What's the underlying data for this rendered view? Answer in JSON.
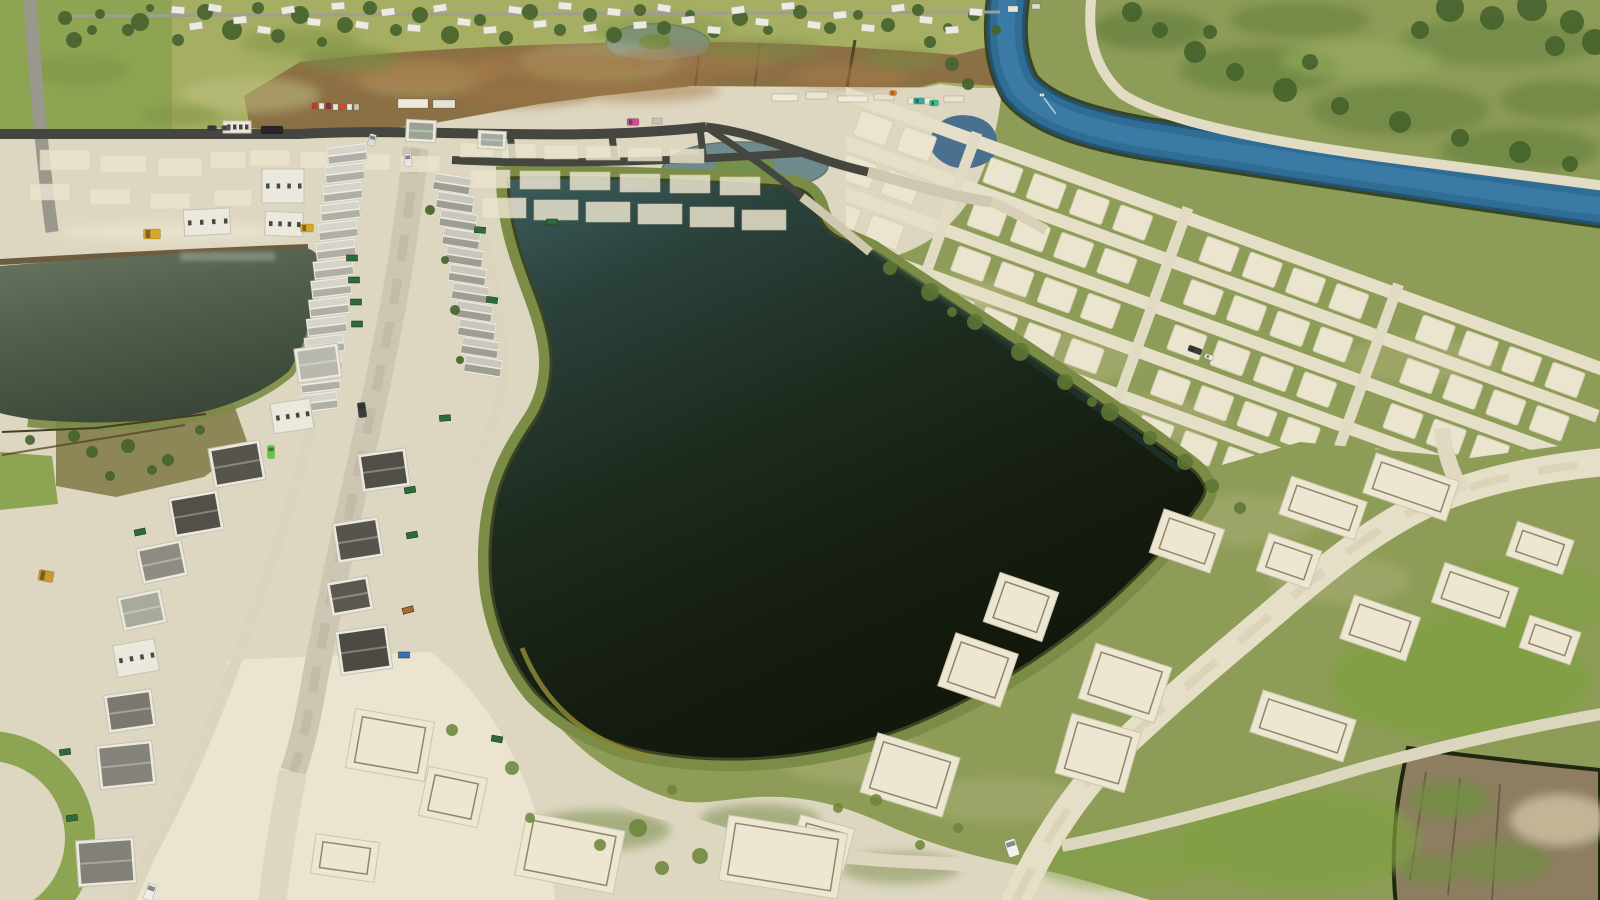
{
  "scene": {
    "kind": "aerial-drone-photo",
    "subject": "residential-construction-site-with-retention-pond-and-canal"
  },
  "palette": {
    "sand": "#ddd7c1",
    "sandBright": "#ece6d2",
    "grass": "#8d9c57",
    "grassTop": "#a5ae62",
    "grassLeft": "#8da452",
    "grassVivid": "#7fa040",
    "scrub": "#8c7045",
    "asphalt": "#45463f",
    "street": "#ccc6b3",
    "dirt": "#dcd5be",
    "canal": "#2f6d94",
    "canalLight": "#3e80ab",
    "canalBank": "#2e3c20",
    "levee": "#e2dcc4",
    "fieldNE": "#83a055",
    "treeGreen": "#46632e",
    "lakeFringe": "#7a8c46",
    "plowField": "#8d7e61",
    "plowEdge": "#20260f",
    "padFill": "#ebe4cf",
    "padEdge": "#d6cfb6",
    "houseWhite": "#ebe8de"
  },
  "trees": [
    [
      65,
      18,
      7
    ],
    [
      92,
      30,
      5
    ],
    [
      140,
      22,
      9
    ],
    [
      178,
      40,
      6
    ],
    [
      205,
      12,
      8
    ],
    [
      232,
      30,
      10
    ],
    [
      258,
      8,
      6
    ],
    [
      278,
      36,
      7
    ],
    [
      300,
      15,
      9
    ],
    [
      322,
      42,
      5
    ],
    [
      345,
      25,
      8
    ],
    [
      370,
      8,
      7
    ],
    [
      396,
      30,
      6
    ],
    [
      420,
      15,
      8
    ],
    [
      450,
      35,
      9
    ],
    [
      480,
      20,
      6
    ],
    [
      506,
      38,
      7
    ],
    [
      530,
      12,
      8
    ],
    [
      560,
      30,
      6
    ],
    [
      590,
      15,
      7
    ],
    [
      614,
      35,
      8
    ],
    [
      640,
      10,
      6
    ],
    [
      664,
      28,
      7
    ],
    [
      690,
      15,
      5
    ],
    [
      714,
      32,
      6
    ],
    [
      740,
      18,
      8
    ],
    [
      768,
      30,
      5
    ],
    [
      800,
      12,
      7
    ],
    [
      830,
      28,
      6
    ],
    [
      858,
      15,
      5
    ],
    [
      888,
      25,
      7
    ],
    [
      918,
      10,
      6
    ],
    [
      948,
      28,
      5
    ],
    [
      974,
      15,
      6
    ],
    [
      996,
      30,
      5
    ],
    [
      100,
      14,
      5
    ],
    [
      128,
      30,
      6
    ],
    [
      74,
      40,
      8
    ],
    [
      150,
      8,
      4
    ],
    [
      1132,
      12,
      10
    ],
    [
      1160,
      30,
      8
    ],
    [
      1195,
      52,
      11
    ],
    [
      1235,
      72,
      9
    ],
    [
      1285,
      90,
      12
    ],
    [
      1340,
      106,
      9
    ],
    [
      1400,
      122,
      11
    ],
    [
      1460,
      138,
      9
    ],
    [
      1520,
      152,
      11
    ],
    [
      1570,
      164,
      8
    ],
    [
      1210,
      32,
      7
    ],
    [
      1310,
      62,
      8
    ],
    [
      1450,
      8,
      14
    ],
    [
      1492,
      18,
      12
    ],
    [
      1532,
      6,
      15
    ],
    [
      1572,
      22,
      12
    ],
    [
      1595,
      42,
      13
    ],
    [
      1555,
      46,
      10
    ],
    [
      1420,
      30,
      9
    ],
    [
      930,
      42,
      6
    ],
    [
      952,
      64,
      7
    ],
    [
      968,
      84,
      6
    ],
    [
      30,
      440,
      5
    ],
    [
      74,
      436,
      6
    ],
    [
      128,
      446,
      7
    ],
    [
      168,
      460,
      6
    ],
    [
      110,
      476,
      5
    ],
    [
      152,
      470,
      5
    ],
    [
      92,
      452,
      6
    ],
    [
      200,
      430,
      5
    ],
    [
      430,
      210,
      5
    ],
    [
      445,
      260,
      4
    ],
    [
      455,
      310,
      5
    ],
    [
      460,
      360,
      4
    ]
  ],
  "nbhdHouses": [
    [
      178,
      10,
      5
    ],
    [
      196,
      26,
      -8
    ],
    [
      215,
      8,
      10
    ],
    [
      240,
      20,
      -5
    ],
    [
      264,
      30,
      8
    ],
    [
      288,
      10,
      -10
    ],
    [
      314,
      22,
      6
    ],
    [
      338,
      6,
      -4
    ],
    [
      362,
      25,
      9
    ],
    [
      388,
      12,
      -7
    ],
    [
      414,
      28,
      4
    ],
    [
      440,
      8,
      -9
    ],
    [
      464,
      22,
      7
    ],
    [
      490,
      30,
      -5
    ],
    [
      515,
      10,
      8
    ],
    [
      540,
      24,
      -6
    ],
    [
      565,
      6,
      5
    ],
    [
      590,
      28,
      -8
    ],
    [
      614,
      12,
      6
    ],
    [
      640,
      25,
      -4
    ],
    [
      664,
      8,
      9
    ],
    [
      688,
      20,
      -6
    ],
    [
      714,
      30,
      5
    ],
    [
      738,
      10,
      -8
    ],
    [
      762,
      22,
      6
    ],
    [
      788,
      6,
      -5
    ],
    [
      814,
      25,
      8
    ],
    [
      840,
      15,
      -6
    ],
    [
      868,
      28,
      5
    ],
    [
      898,
      8,
      -7
    ],
    [
      926,
      20,
      6
    ],
    [
      952,
      30,
      -5
    ],
    [
      976,
      12,
      4
    ]
  ],
  "lots": [
    [
      460,
      143,
      34,
      14
    ],
    [
      502,
      144,
      34,
      14
    ],
    [
      544,
      145,
      34,
      14
    ],
    [
      586,
      146,
      34,
      14
    ],
    [
      628,
      147,
      34,
      14
    ],
    [
      670,
      149,
      34,
      14
    ],
    [
      470,
      170,
      40,
      18
    ],
    [
      520,
      171,
      40,
      18
    ],
    [
      570,
      172,
      40,
      18
    ],
    [
      620,
      174,
      40,
      18
    ],
    [
      670,
      175,
      40,
      18
    ],
    [
      720,
      177,
      40,
      18
    ],
    [
      482,
      198,
      44,
      20
    ],
    [
      534,
      200,
      44,
      20
    ],
    [
      586,
      202,
      44,
      20
    ],
    [
      638,
      204,
      44,
      20
    ],
    [
      690,
      207,
      44,
      20
    ],
    [
      742,
      210,
      44,
      20
    ],
    [
      250,
      150,
      40,
      16
    ],
    [
      300,
      152,
      40,
      16
    ],
    [
      350,
      154,
      40,
      16
    ],
    [
      400,
      156,
      40,
      16
    ],
    [
      40,
      150,
      50,
      20
    ],
    [
      100,
      155,
      46,
      18
    ],
    [
      158,
      158,
      44,
      18
    ],
    [
      30,
      184,
      40,
      16
    ],
    [
      90,
      189,
      40,
      16
    ],
    [
      150,
      193,
      40,
      16
    ],
    [
      210,
      152,
      36,
      16
    ],
    [
      214,
      190,
      38,
      16
    ]
  ],
  "mottles": [
    [
      250,
      95,
      70,
      18,
      "#c2c285",
      0.5
    ],
    [
      420,
      80,
      60,
      15,
      "#bfbf80",
      0.45
    ],
    [
      600,
      62,
      80,
      20,
      "#c2c285",
      0.4
    ],
    [
      80,
      70,
      50,
      16,
      "#7e9346",
      0.5
    ],
    [
      300,
      42,
      60,
      14,
      "#7e9346",
      0.5
    ],
    [
      660,
      30,
      70,
      16,
      "#7e9346",
      0.4
    ],
    [
      180,
      115,
      40,
      10,
      "#7e9346",
      0.5
    ],
    [
      420,
      75,
      80,
      16,
      "#a5794a",
      0.7
    ],
    [
      560,
      66,
      90,
      14,
      "#a5794a",
      0.6
    ],
    [
      700,
      60,
      80,
      14,
      "#a5794a",
      0.6
    ],
    [
      850,
      76,
      60,
      12,
      "#a5794a",
      0.6
    ],
    [
      520,
      95,
      70,
      12,
      "#9b7245",
      0.6
    ],
    [
      640,
      90,
      80,
      12,
      "#a5794a",
      0.5
    ],
    [
      350,
      60,
      50,
      12,
      "#7c8a44",
      0.7
    ],
    [
      760,
      50,
      60,
      10,
      "#7c8a44",
      0.6
    ],
    [
      900,
      60,
      40,
      10,
      "#7c8a44",
      0.6
    ],
    [
      1150,
      30,
      60,
      20,
      "#5e7c3a",
      0.6
    ],
    [
      1260,
      70,
      80,
      24,
      "#5e7c3a",
      0.55
    ],
    [
      1400,
      110,
      90,
      26,
      "#5e7c3a",
      0.5
    ],
    [
      1520,
      150,
      80,
      22,
      "#5e7c3a",
      0.55
    ],
    [
      1300,
      20,
      70,
      18,
      "#5e7c3a",
      0.5
    ],
    [
      1500,
      42,
      100,
      24,
      "#5e7c3a",
      0.45
    ],
    [
      1360,
      60,
      80,
      20,
      "#9ab05e",
      0.5
    ],
    [
      1560,
      100,
      60,
      20,
      "#5e7c3a",
      0.5
    ],
    [
      940,
      300,
      90,
      26,
      "#b9b885",
      0.45
    ],
    [
      1040,
      360,
      100,
      28,
      "#b9b885",
      0.4
    ],
    [
      1140,
      420,
      90,
      24,
      "#b9b885",
      0.4
    ],
    [
      880,
      520,
      60,
      40,
      "#b9b885",
      0.35
    ],
    [
      920,
      620,
      70,
      30,
      "#b9b885",
      0.4
    ],
    [
      1240,
      520,
      80,
      26,
      "#b9b885",
      0.35
    ],
    [
      1340,
      580,
      70,
      24,
      "#b9b885",
      0.35
    ],
    [
      860,
      760,
      80,
      24,
      "#b9b885",
      0.4
    ],
    [
      1000,
      800,
      90,
      22,
      "#b9b885",
      0.35
    ],
    [
      1420,
      360,
      80,
      22,
      "#b9b885",
      0.35
    ],
    [
      600,
      830,
      70,
      20,
      "#6f8440",
      0.5
    ],
    [
      760,
      820,
      60,
      16,
      "#6f8440",
      0.5
    ],
    [
      900,
      868,
      60,
      16,
      "#6f8440",
      0.45
    ],
    [
      1460,
      680,
      130,
      60,
      "#7fa040",
      0.75
    ],
    [
      1300,
      840,
      120,
      50,
      "#7fa040",
      0.7
    ],
    [
      1520,
      600,
      90,
      40,
      "#7fa040",
      0.6
    ],
    [
      1120,
      860,
      90,
      30,
      "#7fa040",
      0.5
    ],
    [
      1450,
      800,
      40,
      18,
      "#6f8f3f",
      0.8
    ],
    [
      1500,
      862,
      50,
      20,
      "#6f8f3f",
      0.7
    ],
    [
      1560,
      820,
      50,
      26,
      "#cfc3a4",
      0.8
    ],
    [
      1430,
      870,
      30,
      14,
      "#6f8f3f",
      0.7
    ],
    [
      180,
      232,
      120,
      10,
      "#e9e3cf",
      0.8
    ],
    [
      960,
      300,
      40,
      12,
      "#c6c490",
      0.5
    ]
  ],
  "neGrid": {
    "x": 852,
    "y": 96,
    "angle": 20,
    "len": 820,
    "roadYs": [
      0,
      46,
      94,
      142,
      190,
      238
    ],
    "rowYs": [
      23,
      69,
      117,
      165,
      213
    ],
    "colX0": 14,
    "colPitch": 46,
    "cols": 17,
    "padW": 34,
    "padH": 26,
    "connXs": [
      130,
      354,
      578
    ]
  },
  "sePads": [
    [
      1187,
      541,
      64,
      46,
      19
    ],
    [
      1323,
      508,
      80,
      40,
      19
    ],
    [
      1411,
      487,
      88,
      42,
      19
    ],
    [
      1021,
      607,
      62,
      52,
      19
    ],
    [
      978,
      670,
      66,
      56,
      19
    ],
    [
      910,
      775,
      86,
      62,
      17
    ],
    [
      822,
      843,
      56,
      44,
      15
    ],
    [
      1380,
      628,
      70,
      46,
      19
    ],
    [
      1475,
      595,
      78,
      42,
      19
    ],
    [
      1303,
      726,
      98,
      44,
      18
    ],
    [
      1125,
      683,
      80,
      58,
      18
    ],
    [
      1098,
      753,
      72,
      62,
      16
    ],
    [
      1289,
      561,
      56,
      40,
      19
    ],
    [
      1540,
      548,
      60,
      36,
      19
    ],
    [
      570,
      853,
      100,
      64,
      11
    ],
    [
      783,
      857,
      120,
      66,
      9
    ],
    [
      453,
      797,
      60,
      50,
      12
    ],
    [
      390,
      745,
      80,
      60,
      10
    ],
    [
      1550,
      640,
      54,
      34,
      19
    ],
    [
      345,
      858,
      64,
      40,
      8
    ]
  ],
  "townhomeRows": [
    {
      "x1": 347,
      "y1": 154,
      "x2": 318,
      "y2": 402,
      "n": 14,
      "rot": -7,
      "w": 38,
      "d": 15,
      "roofA": "#d6d4ca",
      "roofB": "#b0afa5"
    },
    {
      "x1": 452,
      "y1": 184,
      "x2": 483,
      "y2": 366,
      "n": 11,
      "rot": 9,
      "w": 36,
      "d": 15,
      "roofA": "#c9c7bd",
      "roofB": "#9e9d93"
    }
  ],
  "houses": [
    [
      283,
      186,
      0,
      42,
      34,
      "b",
      ""
    ],
    [
      207,
      222,
      -3,
      46,
      26,
      "b",
      ""
    ],
    [
      284,
      224,
      2,
      38,
      24,
      "b",
      ""
    ],
    [
      237,
      127,
      0,
      28,
      12,
      "b",
      ""
    ],
    [
      318,
      363,
      -8,
      44,
      34,
      "r",
      "#b9b8ad"
    ],
    [
      292,
      416,
      -8,
      40,
      30,
      "b",
      ""
    ],
    [
      237,
      464,
      -10,
      52,
      40,
      "r",
      "#57544c"
    ],
    [
      196,
      514,
      -10,
      50,
      40,
      "r",
      "#53504a"
    ],
    [
      162,
      562,
      -12,
      46,
      36,
      "r",
      "#8e8c82"
    ],
    [
      142,
      610,
      -12,
      44,
      34,
      "r",
      "#a8aa9b"
    ],
    [
      136,
      658,
      -10,
      42,
      32,
      "b",
      ""
    ],
    [
      130,
      711,
      -8,
      48,
      38,
      "r",
      "#7b7870"
    ],
    [
      126,
      765,
      -6,
      56,
      44,
      "r",
      "#85827b"
    ],
    [
      106,
      862,
      -4,
      58,
      46,
      "r",
      "#83807a"
    ],
    [
      384,
      470,
      -8,
      48,
      38,
      "r",
      "#514e47"
    ],
    [
      358,
      540,
      -9,
      46,
      40,
      "r",
      "#57544d"
    ],
    [
      350,
      596,
      -10,
      42,
      34,
      "r",
      "#5b5850"
    ],
    [
      364,
      650,
      -8,
      52,
      44,
      "r",
      "#4d4a43"
    ],
    [
      421,
      131,
      3,
      30,
      22,
      "r",
      "#9aa294"
    ],
    [
      492,
      140,
      3,
      28,
      18,
      "r",
      "#a3aaa0"
    ]
  ],
  "dumpsters": [
    [
      352,
      258,
      0,
      ""
    ],
    [
      354,
      280,
      0,
      ""
    ],
    [
      356,
      302,
      0,
      ""
    ],
    [
      357,
      324,
      0,
      ""
    ],
    [
      410,
      490,
      -10,
      ""
    ],
    [
      412,
      535,
      -10,
      ""
    ],
    [
      408,
      610,
      -15,
      "#a96a2f"
    ],
    [
      404,
      655,
      0,
      "#3a6fc0"
    ],
    [
      480,
      230,
      5,
      ""
    ],
    [
      492,
      300,
      8,
      ""
    ],
    [
      140,
      532,
      -12,
      ""
    ],
    [
      65,
      752,
      -8,
      ""
    ],
    [
      72,
      818,
      -8,
      ""
    ],
    [
      497,
      739,
      10,
      ""
    ],
    [
      552,
      222,
      0,
      ""
    ],
    [
      445,
      418,
      -5,
      ""
    ]
  ],
  "vehicles": [
    [
      272,
      130,
      0,
      22,
      8,
      "#26262a"
    ],
    [
      212,
      128,
      0,
      9,
      5,
      "#3a3a40"
    ],
    [
      226,
      128,
      0,
      9,
      5,
      "#55555c"
    ],
    [
      408,
      160,
      -5,
      7,
      13,
      "#e8e8e2"
    ],
    [
      372,
      140,
      15,
      7,
      12,
      "#dcdcd4"
    ],
    [
      362,
      410,
      -8,
      8,
      15,
      "#3c3c40"
    ],
    [
      1012,
      848,
      -18,
      11,
      17,
      "#f2f2ee"
    ],
    [
      150,
      892,
      20,
      9,
      16,
      "#efeee8"
    ],
    [
      152,
      234,
      0,
      17,
      10,
      "#d8a62a"
    ],
    [
      307,
      228,
      0,
      13,
      8,
      "#d8a62a"
    ],
    [
      46,
      576,
      10,
      15,
      11,
      "#c9992b"
    ],
    [
      633,
      122,
      0,
      12,
      7,
      "#cf4f8a"
    ],
    [
      893,
      93,
      0,
      7,
      5,
      "#e07a28"
    ],
    [
      271,
      452,
      0,
      7,
      13,
      "#5ecb3a"
    ],
    [
      919,
      101,
      0,
      11,
      6,
      "#2fae9a"
    ],
    [
      934,
      103,
      0,
      9,
      6,
      "#35c08a"
    ],
    [
      1195,
      350,
      20,
      14,
      6,
      "#3a3a38"
    ],
    [
      1209,
      357,
      20,
      9,
      5,
      "#e8e8e2"
    ],
    [
      1042,
      95,
      0,
      5,
      3,
      "#eef2f2"
    ]
  ],
  "staging": [
    [
      398,
      99,
      30,
      9,
      "#eceadf"
    ],
    [
      433,
      100,
      22,
      8,
      "#e5e2d6"
    ],
    [
      312,
      103,
      5,
      6,
      "#c23b2e"
    ],
    [
      319,
      103,
      5,
      6,
      "#e8e6e0"
    ],
    [
      326,
      103,
      5,
      6,
      "#8a2f2f"
    ],
    [
      333,
      104,
      5,
      6,
      "#e8e6e0"
    ],
    [
      340,
      104,
      5,
      6,
      "#d84a3a"
    ],
    [
      347,
      104,
      5,
      6,
      "#e8e6e0"
    ],
    [
      354,
      104,
      5,
      6,
      "#c8c5ba"
    ],
    [
      772,
      94,
      26,
      7,
      "#eee9d8"
    ],
    [
      806,
      92,
      22,
      7,
      "#e9e4d2"
    ],
    [
      838,
      96,
      30,
      6,
      "#f0ebda"
    ],
    [
      874,
      94,
      20,
      6,
      "#e7e2d0"
    ],
    [
      908,
      98,
      26,
      6,
      "#eee9d8"
    ],
    [
      944,
      96,
      20,
      6,
      "#e9e4d2"
    ],
    [
      652,
      118,
      10,
      6,
      "#c9c2b2"
    ],
    [
      1008,
      6,
      10,
      6,
      "#e8e6da"
    ],
    [
      1032,
      4,
      8,
      5,
      "#dfe0d4"
    ]
  ],
  "weeds": [
    [
      638,
      828,
      9
    ],
    [
      662,
      868,
      7
    ],
    [
      600,
      845,
      6
    ],
    [
      700,
      856,
      8
    ],
    [
      512,
      768,
      7
    ],
    [
      452,
      730,
      6
    ],
    [
      530,
      818,
      5
    ],
    [
      672,
      790,
      5
    ],
    [
      876,
      800,
      6
    ],
    [
      958,
      828,
      5
    ],
    [
      920,
      845,
      5
    ],
    [
      838,
      808,
      5
    ]
  ],
  "brush": [
    [
      890,
      268,
      7
    ],
    [
      930,
      292,
      9
    ],
    [
      975,
      322,
      8
    ],
    [
      1020,
      352,
      9
    ],
    [
      1065,
      382,
      8
    ],
    [
      1110,
      412,
      9
    ],
    [
      1150,
      438,
      7
    ],
    [
      1185,
      462,
      8
    ],
    [
      952,
      312,
      5
    ],
    [
      1092,
      402,
      5
    ],
    [
      1212,
      486,
      7
    ],
    [
      1240,
      508,
      6
    ]
  ]
}
